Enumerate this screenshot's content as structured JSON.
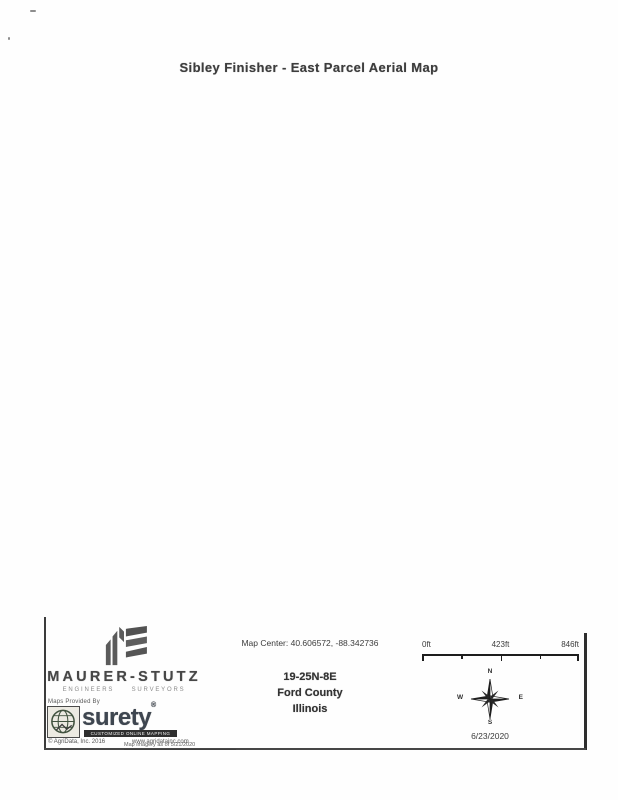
{
  "title": "Sibley Finisher - East Parcel Aerial Map",
  "footer": {
    "firm": {
      "name": "MAURER-STUTZ",
      "tagline": "ENGINEERS SURVEYORS"
    },
    "provider": {
      "label": "Maps Provided By",
      "brand": "surety",
      "reg": "®",
      "strap": "CUSTOMIZED ONLINE MAPPING",
      "copyright": "© AgriData, Inc. 2016",
      "website": "www.agridatainc.com",
      "note": "Map imagery as of 5/21/2020"
    },
    "map_center": "Map Center: 40.606572, -88.342736",
    "location": {
      "trs": "19-25N-8E",
      "county": "Ford County",
      "state": "Illinois"
    },
    "scale_bar": {
      "start": "0ft",
      "mid": "423ft",
      "end": "846ft"
    },
    "compass": {
      "n": "N",
      "e": "E",
      "s": "S",
      "w": "W"
    },
    "date": "6/23/2020"
  },
  "colors": {
    "ink": "#3a3a3a",
    "logo_gray": "#5b5b5b",
    "brand_slate": "#3e4650"
  }
}
